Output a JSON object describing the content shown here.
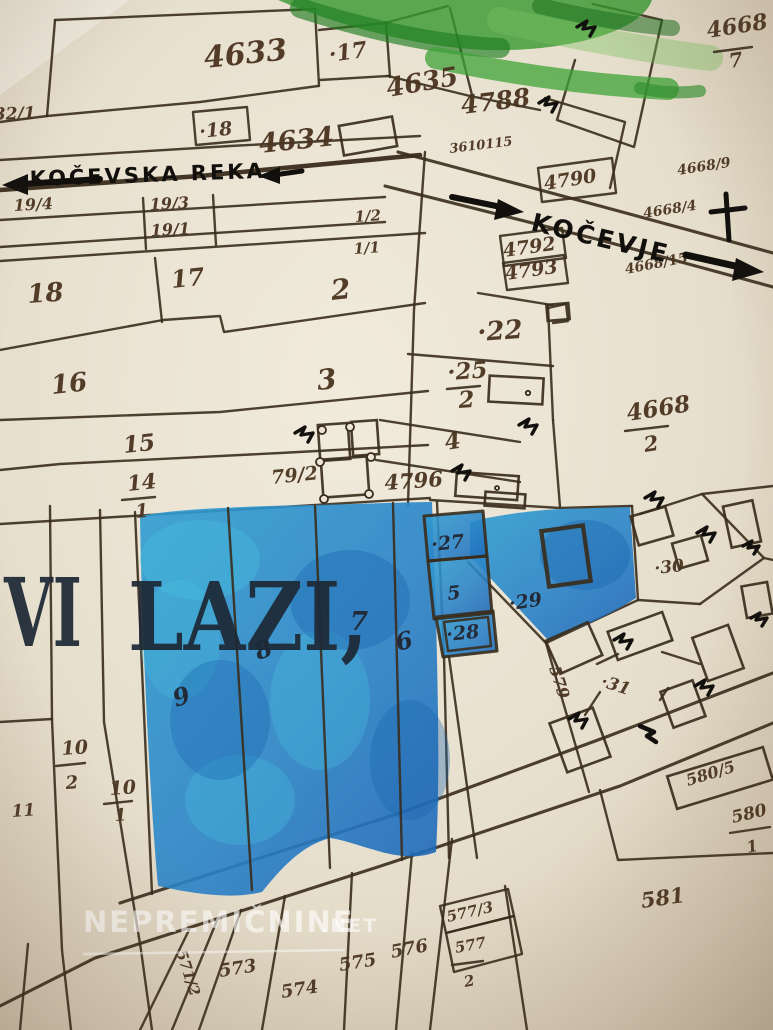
{
  "title": {
    "part1": "VI",
    "part2": "LAZI,"
  },
  "annotations": {
    "river": "KOČEVSKA REKA",
    "town": "KOČEVJE"
  },
  "watermark": {
    "name": "NEPREMIČNINE",
    "tld": ".NET"
  },
  "colors": {
    "paper": "#ece5d6",
    "ink": "#3a2c1c",
    "num": "#4a3420",
    "navy": "#1d2936",
    "marker": "#12100d",
    "blue": "#2a8fcc",
    "blue_deep": "#1e66b8",
    "cyan": "#46bddd",
    "green": "#379a31",
    "wm": "#ffffff"
  },
  "parcel_labels": [
    {
      "t": "4633",
      "x": 205,
      "y": 68,
      "s": 30,
      "r": -6
    },
    {
      "t": "·17",
      "x": 330,
      "y": 62,
      "s": 22,
      "r": -8
    },
    {
      "t": "4635",
      "x": 388,
      "y": 97,
      "s": 26,
      "r": -10
    },
    {
      "t": "·18",
      "x": 200,
      "y": 138,
      "s": 19,
      "r": -6
    },
    {
      "t": "4634",
      "x": 260,
      "y": 153,
      "s": 27,
      "r": -6
    },
    {
      "t": "4788",
      "x": 462,
      "y": 114,
      "s": 25,
      "r": -7
    },
    {
      "t": "3610115",
      "x": 450,
      "y": 153,
      "s": 13,
      "r": -7
    },
    {
      "t": "4668",
      "x": 708,
      "y": 38,
      "s": 22,
      "r": -9
    },
    {
      "t": "7",
      "x": 730,
      "y": 68,
      "s": 20,
      "r": -9
    },
    {
      "t": "32/1",
      "x": -6,
      "y": 120,
      "s": 17,
      "r": -2
    },
    {
      "t": "19/4",
      "x": 14,
      "y": 211,
      "s": 16,
      "r": -3
    },
    {
      "t": "19/3",
      "x": 150,
      "y": 210,
      "s": 16,
      "r": -3
    },
    {
      "t": "19/1",
      "x": 151,
      "y": 236,
      "s": 16,
      "r": -3
    },
    {
      "t": "1/2",
      "x": 355,
      "y": 222,
      "s": 15,
      "r": -4
    },
    {
      "t": "1/1",
      "x": 354,
      "y": 254,
      "s": 15,
      "r": -4
    },
    {
      "t": "4790",
      "x": 545,
      "y": 190,
      "s": 19,
      "r": -9
    },
    {
      "t": "4792",
      "x": 504,
      "y": 257,
      "s": 19,
      "r": -8
    },
    {
      "t": "4793",
      "x": 506,
      "y": 280,
      "s": 19,
      "r": -8
    },
    {
      "t": "4668/9",
      "x": 678,
      "y": 175,
      "s": 14,
      "r": -9
    },
    {
      "t": "4668/4",
      "x": 644,
      "y": 218,
      "s": 14,
      "r": -9
    },
    {
      "t": "4668/15",
      "x": 626,
      "y": 274,
      "s": 14,
      "r": -11
    },
    {
      "t": "18",
      "x": 28,
      "y": 303,
      "s": 26,
      "r": -4
    },
    {
      "t": "17",
      "x": 172,
      "y": 288,
      "s": 24,
      "r": -6
    },
    {
      "t": "2",
      "x": 332,
      "y": 300,
      "s": 28,
      "r": -6
    },
    {
      "t": "16",
      "x": 52,
      "y": 394,
      "s": 26,
      "r": -6
    },
    {
      "t": "3",
      "x": 318,
      "y": 390,
      "s": 28,
      "r": -6
    },
    {
      "t": "·22",
      "x": 478,
      "y": 341,
      "s": 26,
      "r": -4
    },
    {
      "t": "·25",
      "x": 448,
      "y": 380,
      "s": 23,
      "r": -4
    },
    {
      "t": "2",
      "x": 459,
      "y": 408,
      "s": 23,
      "r": -4
    },
    {
      "t": "4668",
      "x": 628,
      "y": 421,
      "s": 23,
      "r": -9
    },
    {
      "t": "2",
      "x": 645,
      "y": 452,
      "s": 21,
      "r": -9
    },
    {
      "t": "15",
      "x": 124,
      "y": 453,
      "s": 23,
      "r": -6
    },
    {
      "t": "14",
      "x": 128,
      "y": 491,
      "s": 21,
      "r": -6
    },
    {
      "t": "1",
      "x": 136,
      "y": 518,
      "s": 19,
      "r": -6
    },
    {
      "t": "79/2",
      "x": 272,
      "y": 484,
      "s": 19,
      "r": -6
    },
    {
      "t": "4796",
      "x": 385,
      "y": 490,
      "s": 21,
      "r": -4
    },
    {
      "t": "4",
      "x": 446,
      "y": 450,
      "s": 23,
      "r": -9
    },
    {
      "t": "·27",
      "x": 432,
      "y": 551,
      "s": 19,
      "r": -6,
      "c": "dk"
    },
    {
      "t": "5",
      "x": 448,
      "y": 600,
      "s": 19,
      "r": -6,
      "c": "dk"
    },
    {
      "t": "·28",
      "x": 447,
      "y": 641,
      "s": 19,
      "r": -6,
      "c": "dk"
    },
    {
      "t": "·29",
      "x": 510,
      "y": 610,
      "s": 19,
      "r": -8,
      "c": "dk"
    },
    {
      "t": "·30",
      "x": 655,
      "y": 574,
      "s": 17,
      "r": -6
    },
    {
      "t": "7",
      "x": 350,
      "y": 630,
      "s": 26,
      "r": 0,
      "c": "dk"
    },
    {
      "t": "8",
      "x": 258,
      "y": 660,
      "s": 24,
      "r": -18,
      "c": "dk"
    },
    {
      "t": "6",
      "x": 398,
      "y": 651,
      "s": 24,
      "r": -14,
      "c": "dk"
    },
    {
      "t": "9",
      "x": 176,
      "y": 707,
      "s": 24,
      "r": -18,
      "c": "dk"
    },
    {
      "t": "579",
      "x": 549,
      "y": 668,
      "s": 16,
      "r": 72
    },
    {
      "t": "·31",
      "x": 600,
      "y": 686,
      "s": 17,
      "r": 18
    },
    {
      "t": "10",
      "x": 62,
      "y": 755,
      "s": 19,
      "r": -4
    },
    {
      "t": "2",
      "x": 66,
      "y": 789,
      "s": 18,
      "r": -4
    },
    {
      "t": "10",
      "x": 110,
      "y": 795,
      "s": 19,
      "r": -4
    },
    {
      "t": "1",
      "x": 115,
      "y": 821,
      "s": 17,
      "r": -4
    },
    {
      "t": "11",
      "x": 12,
      "y": 817,
      "s": 17,
      "r": -4
    },
    {
      "t": "580/5",
      "x": 688,
      "y": 786,
      "s": 16,
      "r": -17
    },
    {
      "t": "580",
      "x": 733,
      "y": 823,
      "s": 17,
      "r": -13
    },
    {
      "t": "1",
      "x": 748,
      "y": 853,
      "s": 16,
      "r": -13
    },
    {
      "t": "581",
      "x": 642,
      "y": 908,
      "s": 21,
      "r": -8
    },
    {
      "t": "577/3",
      "x": 448,
      "y": 922,
      "s": 15,
      "r": -13
    },
    {
      "t": "577",
      "x": 456,
      "y": 953,
      "s": 15,
      "r": -11
    },
    {
      "t": "2",
      "x": 465,
      "y": 987,
      "s": 15,
      "r": -11
    },
    {
      "t": "576",
      "x": 392,
      "y": 958,
      "s": 18,
      "r": -11
    },
    {
      "t": "575",
      "x": 340,
      "y": 971,
      "s": 18,
      "r": -9
    },
    {
      "t": "574",
      "x": 282,
      "y": 998,
      "s": 18,
      "r": -9
    },
    {
      "t": "573",
      "x": 220,
      "y": 977,
      "s": 18,
      "r": -9
    },
    {
      "t": "571/2",
      "x": 176,
      "y": 952,
      "s": 15,
      "r": 72
    }
  ]
}
